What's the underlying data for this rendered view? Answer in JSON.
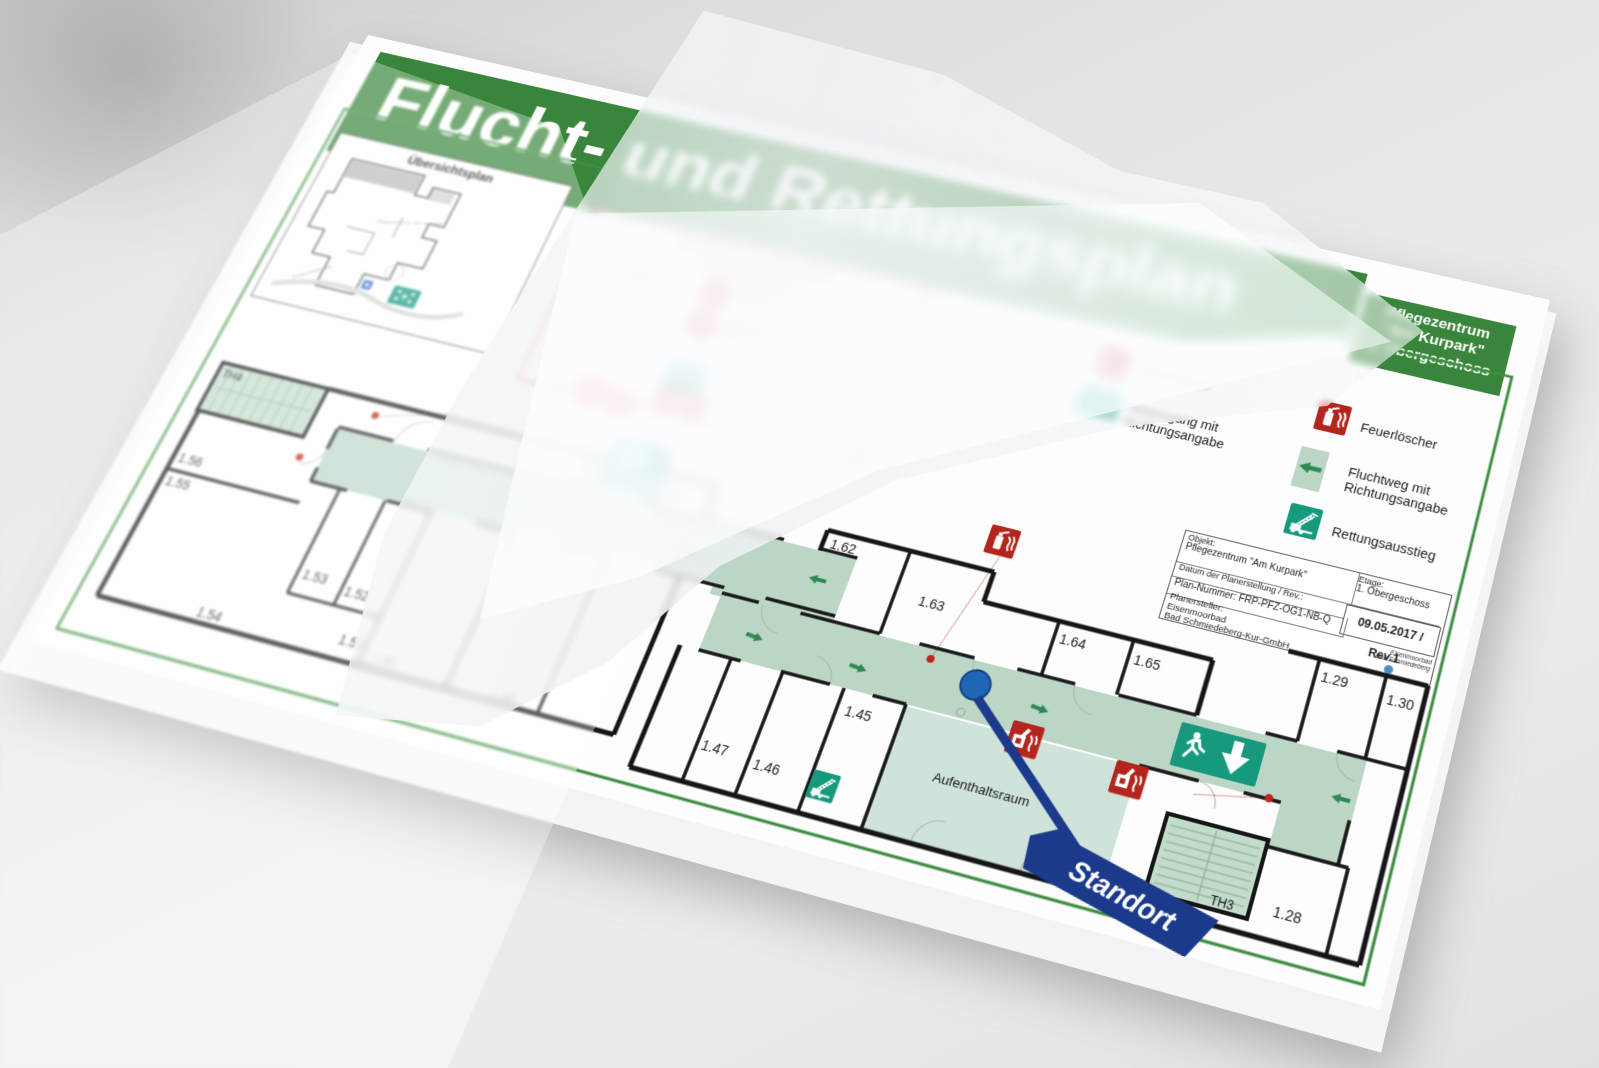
{
  "title": "Flucht- und Rettungsplan",
  "object_box": {
    "line1": "Pflegezentrum",
    "line2": "\"Am Kurpark\"",
    "line3": "1. Obergeschoss"
  },
  "overview": {
    "title": "Übersichtsplan",
    "street": "Kurpromenade",
    "building": "Pflegezentrum \"Am Kurpark\""
  },
  "behaviour": {
    "title": "Verhalten im Brandfall",
    "n1": "1.",
    "calm": "Ruhe bewahren",
    "report": "Brand melden",
    "call1": "Brandmelder",
    "call2": "betätigen",
    "tel": "Telefon: 0-112",
    "mob": "Mobil: 112",
    "n2": "2.",
    "save1": "In Sicherheit",
    "save2": "bringen",
    "n3": "3.",
    "ext1": "Löschversuch",
    "ext2": "unternehmen"
  },
  "legend": {
    "brandmelder": "Brandmelder",
    "notausgang_1": "Notausgang mit",
    "notausgang_2": "Richtungsangabe",
    "feuerloescher": "Feuerlöscher",
    "fluchtweg_1": "Fluchtweg mit",
    "fluchtweg_2": "Richtungsangabe",
    "rettungsausstieg": "Rettungsausstieg"
  },
  "info": {
    "objekt_label": "Objekt:",
    "objekt_value": "Pflegezentrum \"Am Kurpark\"",
    "etage_label": "Etage:",
    "etage_value": "1. Obergeschoss",
    "datum_label": "Datum der Planerstellung / Rev.:",
    "datum_value": "09.05.2017 / Rev.1",
    "plannummer": "Plan-Nummer: FRP-PFZ-OG1-NB-Q",
    "planersteller_label": "Planersteller:",
    "planersteller_value1": "Eisenmoorbad",
    "planersteller_value2": "Bad Schmiedeberg-Kur-GmbH",
    "logo_line1": "Eisenmoorbad",
    "logo_line2": "Bad Schmiedeberg"
  },
  "plan": {
    "rooms": {
      "th4": "TH4",
      "r157": "1.57",
      "r158": "1.58",
      "r156": "1.56",
      "r155": "1.55",
      "r153": "1.53",
      "r152": "1.52",
      "r154": "1.54",
      "r151": "1.51",
      "r150": "1.50",
      "r148": "1.48",
      "r147": "1.47",
      "r146": "1.46",
      "r145": "1.45",
      "r162": "1.62",
      "r163": "1.63",
      "r164": "1.64",
      "r165": "1.65",
      "r129": "1.29",
      "r130": "1.30",
      "r128": "1.28",
      "th3": "TH3",
      "aufenthaltsraum": "Aufenthaltsraum"
    },
    "standort": "Standort"
  },
  "colors": {
    "header_green": "#3a853c",
    "sign_green": "#17997e",
    "route_green": "#bcd6c6",
    "alarm_red": "#b3251d",
    "standort_blue": "#1c3a8c",
    "marker_blue": "#1f67b5"
  }
}
